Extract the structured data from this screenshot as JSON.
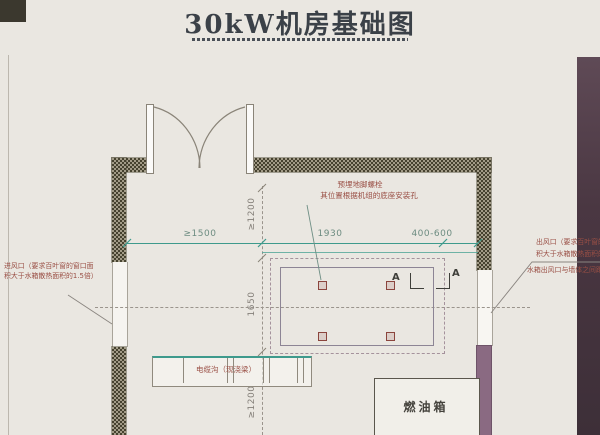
{
  "title": {
    "text": "30kW机房基础图"
  },
  "palette": {
    "background": "#eae7e1",
    "dimension_teal": "#3e9a8c",
    "annotation_red": "#9a4f45",
    "wall_hatch_dark": "#46422f",
    "right_wall_solid": "#8a6a82",
    "scan_edge_band": "#4a3742"
  },
  "dimensions": {
    "left_clearance": "≥1500",
    "pad_length": "1930",
    "right_gap": "400-600",
    "top_clearance": "≥1200",
    "pad_width": "1650",
    "bottom_clearance": "≥1200"
  },
  "annotations": {
    "anchor_bolt": {
      "line1": "预埋地脚螺栓",
      "line2": "其位置根据机组的底座安装孔"
    },
    "air_inlet": {
      "line1": "进风口（要求百叶窗的窗口面",
      "line2": "积大于水箱散热面积的1.5倍）"
    },
    "air_outlet": {
      "line1": "出风口（要求百叶窗的窗口面",
      "line2": "积大于水箱散热面积的",
      "line3": "水箱出风口与墙体之间距"
    }
  },
  "labels": {
    "cable_trench": "电缆沟（现浇梁）",
    "fuel_tank": "燃油箱",
    "section_marker_left": "A",
    "section_marker_right": "A"
  }
}
